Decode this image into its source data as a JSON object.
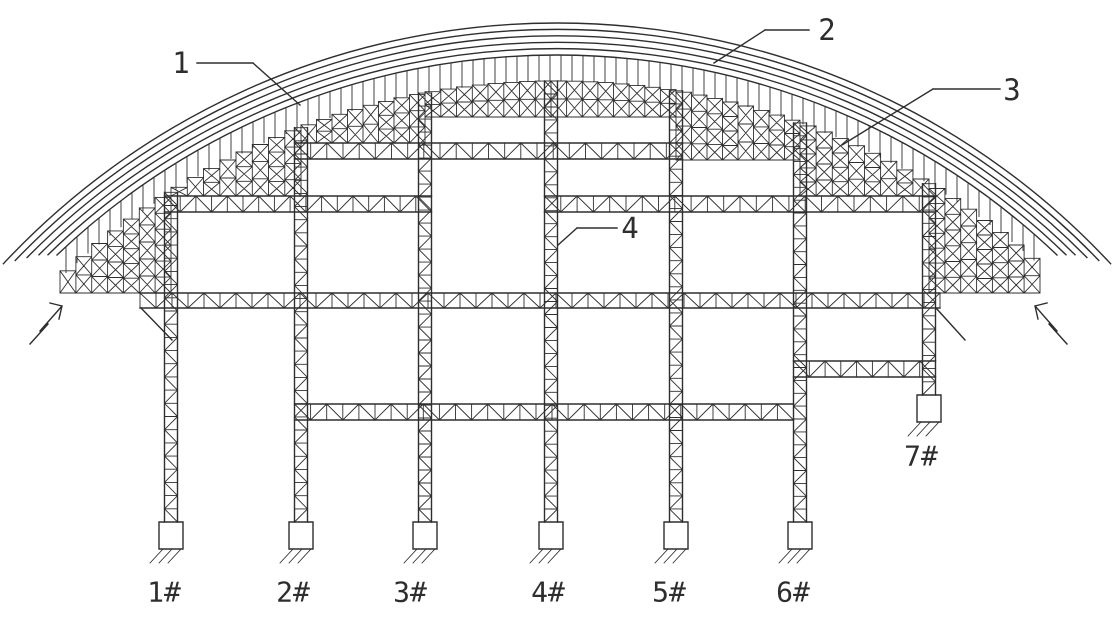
{
  "drawing": {
    "background": "#ffffff",
    "line_color": "#2e2e2e",
    "callouts": [
      {
        "label": "1"
      },
      {
        "label": "2"
      },
      {
        "label": "3"
      },
      {
        "label": "4"
      }
    ],
    "supports": [
      {
        "label": "1#"
      },
      {
        "label": "2#"
      },
      {
        "label": "3#"
      },
      {
        "label": "4#"
      },
      {
        "label": "5#"
      },
      {
        "label": "6#"
      },
      {
        "label": "7#"
      }
    ]
  }
}
